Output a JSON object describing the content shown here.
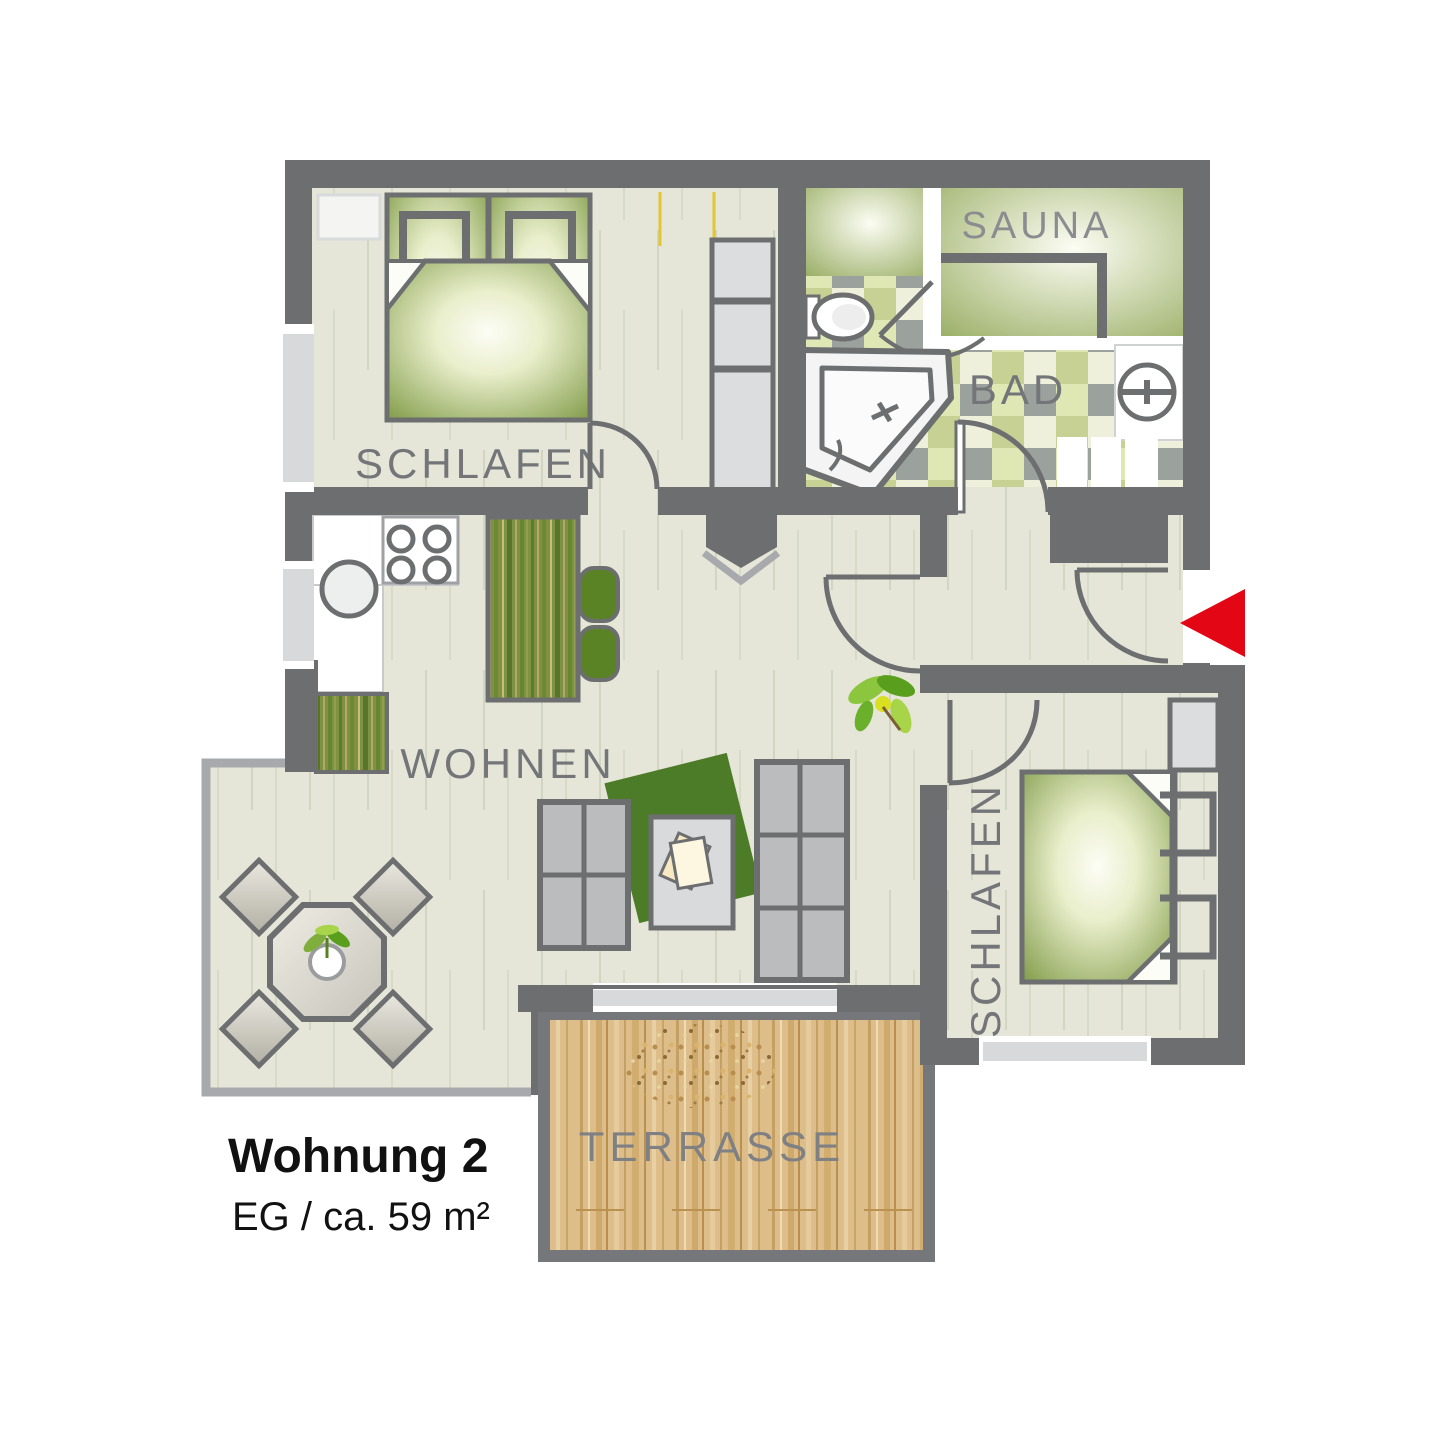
{
  "title": {
    "name": "Wohnung 2",
    "details": "EG / ca. 59 m²"
  },
  "rooms": {
    "bedroom1": {
      "label": "SCHLAFEN"
    },
    "sauna": {
      "label": "SAUNA"
    },
    "bath": {
      "label": "BAD"
    },
    "living": {
      "label": "WOHNEN"
    },
    "bedroom2": {
      "label": "SCHLAFEN"
    },
    "terrace": {
      "label": "TERRASSE"
    }
  },
  "entrance": {
    "marker": "red-arrow-left"
  },
  "colors": {
    "wall": "#6c6e70",
    "floor": "#e5e6d8",
    "accent_red": "#e30615",
    "bed_green": "#7f9a46",
    "rug_green": "#4d7c28",
    "terrace_wood": "#ddbe8b",
    "tile_green": "#dfe8b4",
    "label_gray": "#737578"
  }
}
